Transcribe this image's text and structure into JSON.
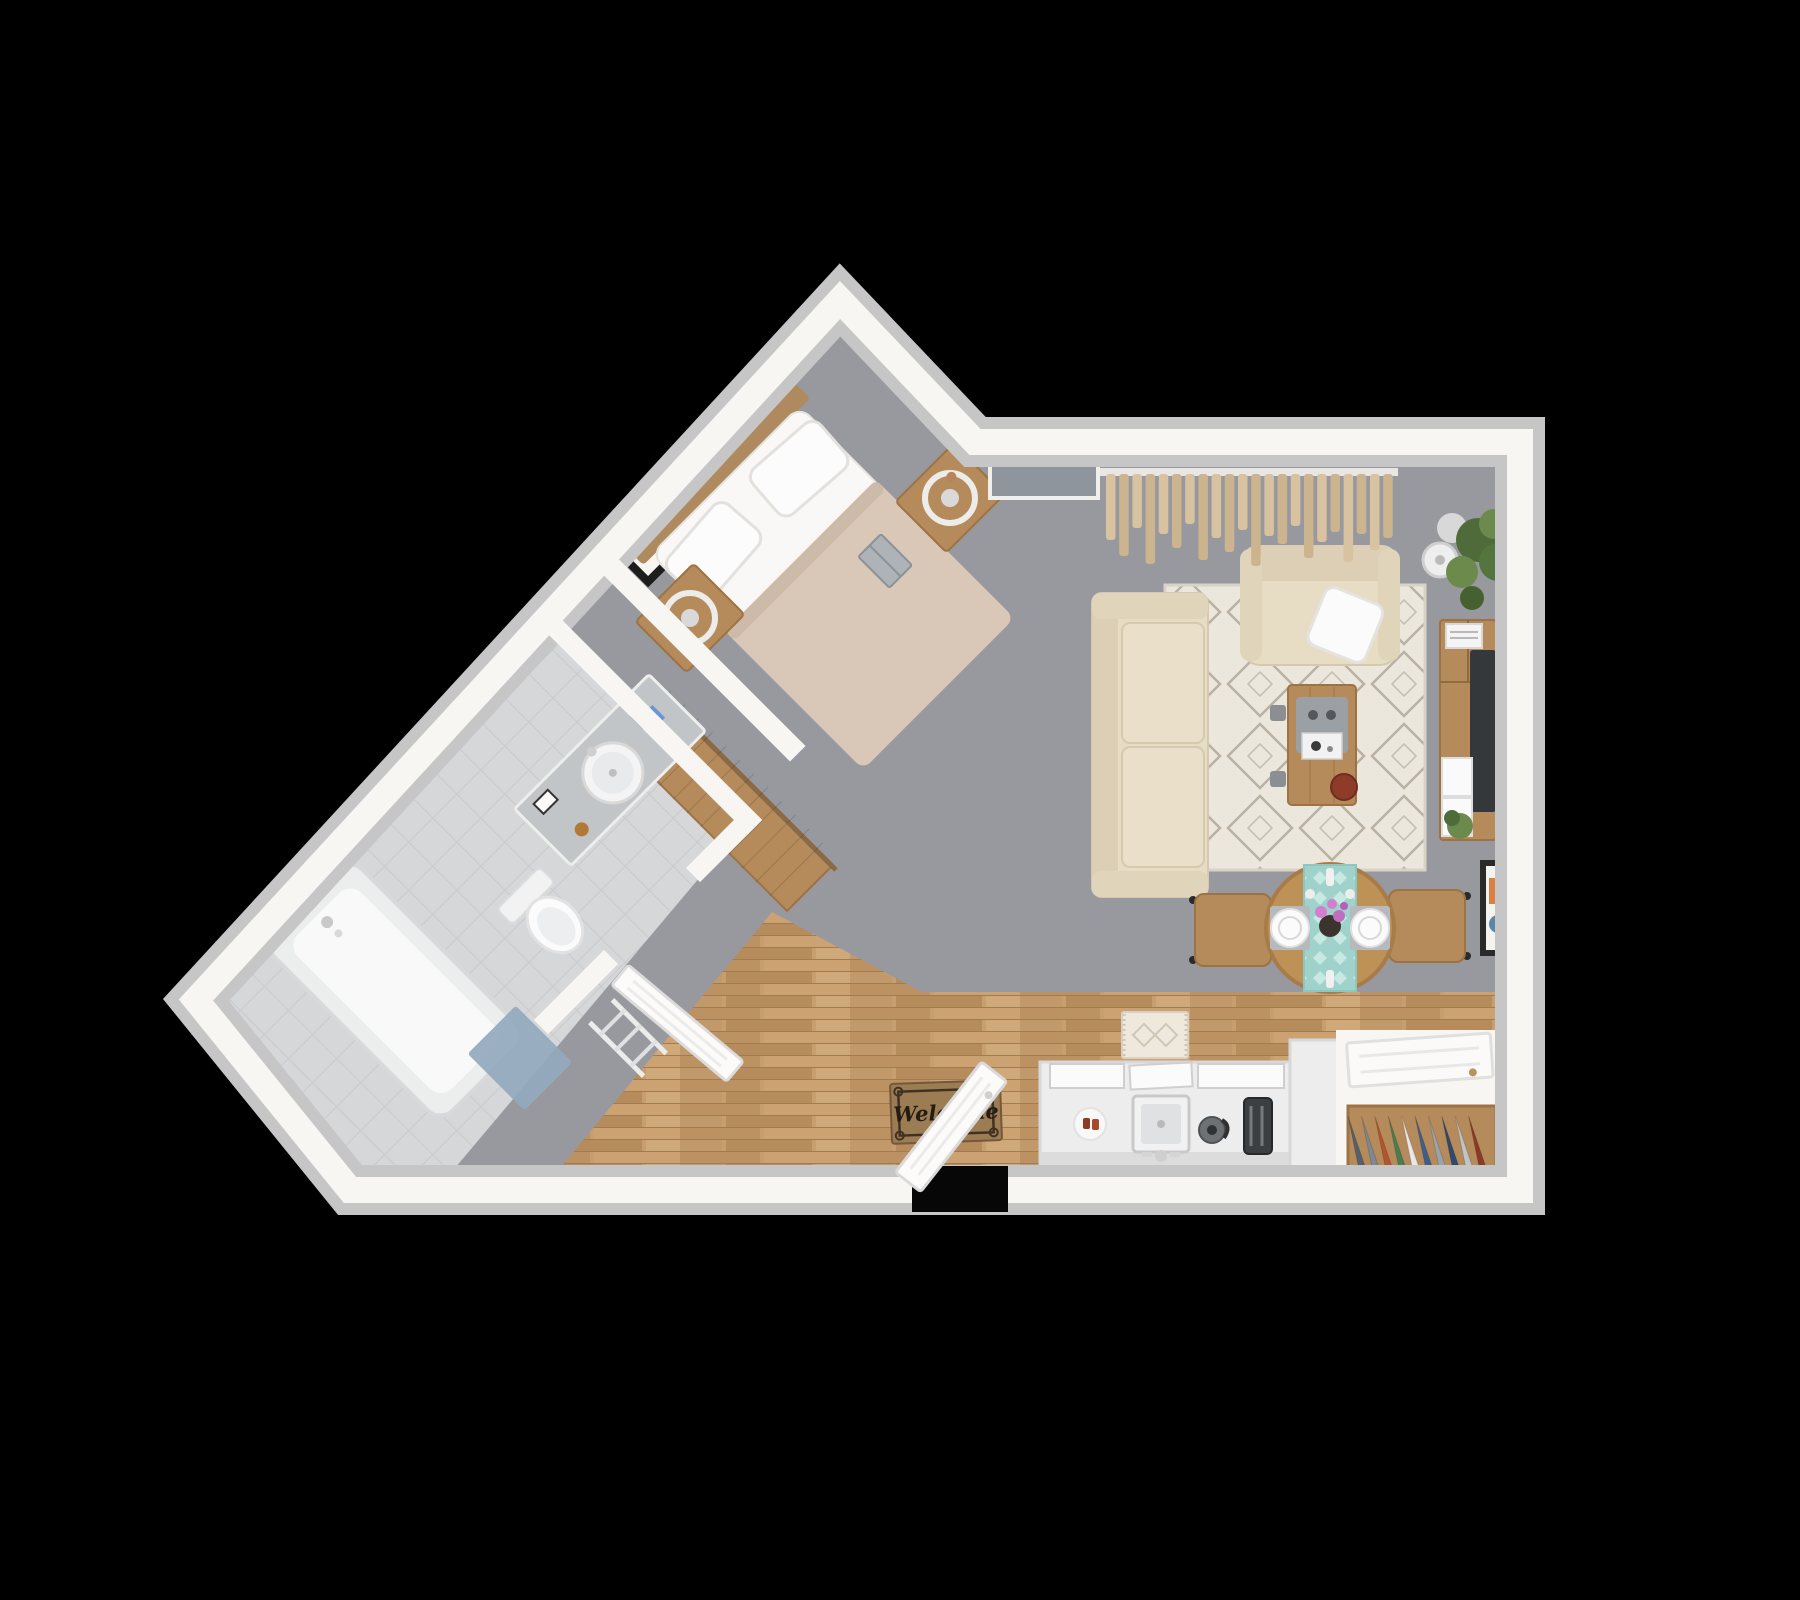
{
  "meta": {
    "title": "Studio apartment 3D floor plan",
    "view": "top-down 3D render",
    "background": "#000000"
  },
  "entry": {
    "welcome_mat_text": "Welcome",
    "doormat_label": "welcome-doormat",
    "door_state": "open"
  },
  "palette": {
    "bg": "#000000",
    "wall_outer": "#c6c6c6",
    "wall_inner": "#f7f6f3",
    "carpet": "#97999f",
    "tile": "#d6d7d9",
    "wood_floor": "#c79f6f",
    "furniture_wood": "#b68b5b",
    "furniture_wood_dark": "#9d7344",
    "headboard_wood": "#b08a5f",
    "sofa": "#e7dcc4",
    "sofa_shade": "#dccfb6",
    "cushion": "#eadfc9",
    "rug": "#ece7dc",
    "rug_line": "#b9b1a3",
    "duvet": "#d9c8b8",
    "duvet_fold": "#cdbaa9",
    "linen": "#f9f8f6",
    "tv": "#35383b",
    "teal_runner": "#9ed2cb",
    "doormat": "#9c7c52",
    "doormat_border": "#3f3222",
    "doormat_text": "#241c12",
    "counter": "#ededed",
    "appliance_dark": "#3c3f42",
    "kettle_gray": "#6e7174",
    "blue_mat": "#93a9bd",
    "plant_green": "#4e6b39",
    "plant_green_light": "#6b8a4c",
    "red_plate": "#8e3b2a",
    "pink_flower": "#d27fd0",
    "lamp_white": "#eeeeee",
    "window_panel": "#8e959d",
    "curtain_a": "#d8c2a0",
    "curtain_b": "#cbb48e",
    "tray_gray": "#9aa0a3",
    "vanity": "#c2c5c7",
    "art_orange": "#d97f3f",
    "art_blue": "#5b86a8"
  },
  "curtains": {
    "strip_lengths": [
      66,
      82,
      54,
      90,
      60,
      74,
      50,
      86,
      64,
      78,
      56,
      92,
      62,
      70,
      52,
      84,
      68,
      58,
      88,
      60,
      76,
      64
    ]
  },
  "closets": {
    "main": {
      "clothes_colors": [
        "#3f5f8a",
        "#7d8894",
        "#b4542e",
        "#e9e9e9",
        "#49818a",
        "#2f4a6e",
        "#9aa3ac",
        "#b4542e",
        "#d8d8d8",
        "#5b6d7e",
        "#3f5f8a",
        "#8a6a4a"
      ]
    },
    "entry": {
      "clothes_colors": [
        "#56606b",
        "#7d8894",
        "#b4542e",
        "#4a7d52",
        "#e8e8e8",
        "#3f5f8a",
        "#9aa3ac",
        "#2f4a6e",
        "#c0c5c9",
        "#8a3b28"
      ]
    }
  },
  "rooms": {
    "bedroom": {
      "name": "Bedroom",
      "floor": "gray carpet",
      "furniture": [
        "double bed with wood headboard",
        "beige duvet",
        "two white pillows",
        "book",
        "nightstand with ring lamp (left)",
        "nightstand with ring lamp (right)",
        "two framed wall pictures"
      ]
    },
    "bathroom": {
      "name": "Bathroom",
      "floor": "light gray tile",
      "furniture": [
        "vanity with round sink",
        "toilet",
        "bathtub with faucet",
        "blue bath mat",
        "towel ladder",
        "open door"
      ]
    },
    "wardrobe": {
      "name": "Wardrobe closet",
      "furniture": [
        "clothes rod with hanging clothes"
      ]
    },
    "living_room": {
      "name": "Living room",
      "floor": "gray carpet",
      "furniture": [
        "beige sofa",
        "beige armchair with white pillow",
        "diamond pattern rug",
        "wood coffee table with tray and red plate",
        "TV console with flat TV, magazines and plants",
        "corner potted plant",
        "white floor lamp",
        "tan curtains",
        "gray window panel",
        "framed wall art"
      ]
    },
    "dining_area": {
      "name": "Dining area",
      "furniture": [
        "round wood table",
        "teal table runner",
        "two place settings",
        "vase with pink flowers",
        "two wood chairs"
      ]
    },
    "kitchen": {
      "name": "Kitchen / hallway",
      "floor": "wood planks",
      "furniture": [
        "white counter with square sink",
        "plate of food",
        "kettle",
        "toaster",
        "cabinet fronts",
        "return counter",
        "entry closet with hanging clothes",
        "white sliding door",
        "cream runner rug",
        "welcome doormat",
        "open entry door"
      ]
    }
  }
}
